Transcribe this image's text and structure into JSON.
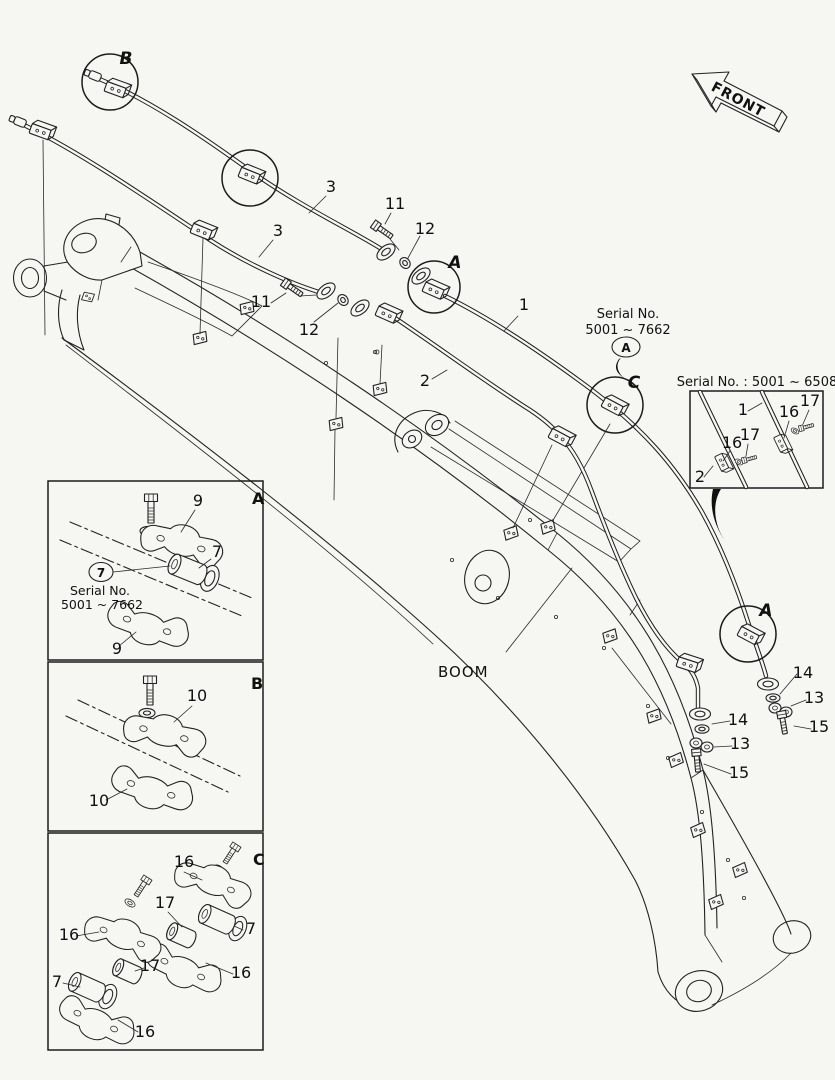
{
  "labels": {
    "boom": "BOOM",
    "front": "FRONT"
  },
  "detail_markers": {
    "circle_b": "B",
    "circle_a_top": "A",
    "circle_c": "C",
    "circle_a_right": "A"
  },
  "serial_note": {
    "line1": "Serial No.",
    "line2": "5001 ~ 7662",
    "badge": "A"
  },
  "callouts": {
    "pipe3_upper": "3",
    "bolt11_upper": "11",
    "washer12_upper": "12",
    "pipe3_lower": "3",
    "bolt11_lower": "11",
    "washer12_lower": "12",
    "pipe1": "1",
    "pipe2": "2",
    "grommet14_outer": "14",
    "clamp13_outer": "13",
    "bolt15_outer": "15",
    "grommet14_inner": "14",
    "clamp13_inner": "13",
    "bolt15_inner": "15"
  },
  "inset": {
    "title": "Serial No. : 5001 ~ 6508",
    "pipe1": "1",
    "pipe2": "2",
    "clamp16_right": "16",
    "bolt17_right": "17",
    "clamp16_left": "16",
    "bolt17_left": "17"
  },
  "panel_a": {
    "corner": "A",
    "clamp_upper": "9",
    "clamp_lower": "9",
    "bushing": "7",
    "bushing_badge": "7",
    "serial1": "Serial No.",
    "serial2": "5001 ~ 7662"
  },
  "panel_b": {
    "corner": "B",
    "clamp_upper": "10",
    "clamp_lower": "10"
  },
  "panel_c": {
    "corner": "C",
    "right_clamp_upper": "16",
    "right_bushing_17": "17",
    "right_bushing_7": "7",
    "right_clamp_lower": "16",
    "left_clamp_upper": "16",
    "left_bushing_17": "17",
    "left_bushing_7": "7",
    "left_clamp_lower": "16"
  }
}
